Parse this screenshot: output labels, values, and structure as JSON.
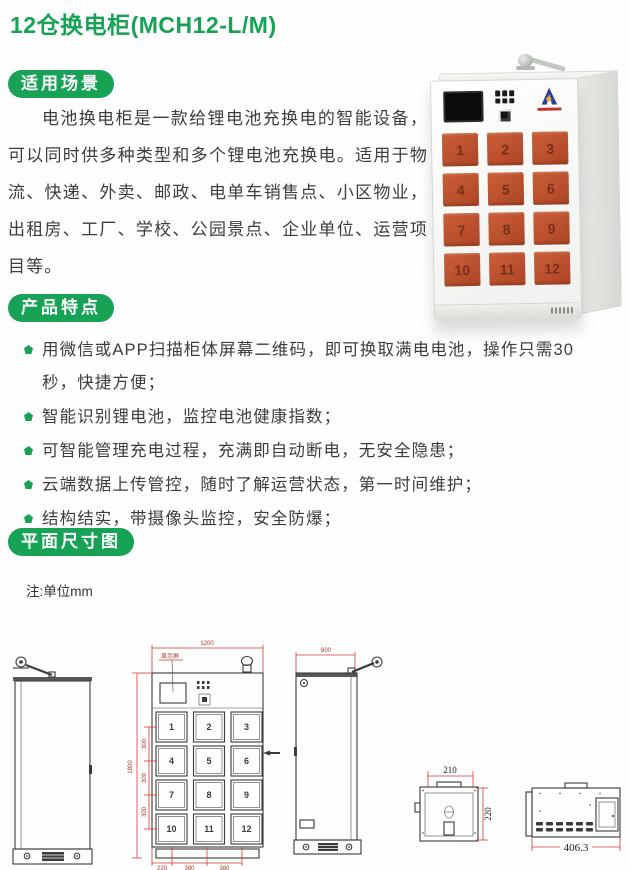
{
  "title": "12仓换电柜(MCH12-L/M)",
  "colors": {
    "accent_green": "#17a256",
    "door_orange": "#bf4e2e",
    "dimension_red": "#d93a2e",
    "logo_blue": "#2b3f9d"
  },
  "usage": {
    "badge": "适用场景",
    "paragraph": "电池换电柜是一款给锂电池充换电的智能设备，可以同时供多种类型和多个锂电池充换电。适用于物流、快递、外卖、邮政、电单车销售点、小区物业，出租房、工厂、学校、公园景点、企业单位、运营项目等。"
  },
  "features": {
    "badge": "产品特点",
    "items": [
      "用微信或APP扫描柜体屏幕二维码，即可换取满电电池，操作只需30秒，快捷方便；",
      "智能识别锂电池，监控电池健康指数；",
      "可智能管理充电过程，充满即自动断电，无安全隐患；",
      "云端数据上传管控，随时了解运营状态，第一时间维护；",
      "结构结实，带摄像头监控，安全防爆；"
    ]
  },
  "dims_section": {
    "badge": "平面尺寸图",
    "note": "注:单位mm"
  },
  "cabinet": {
    "doors": [
      "1",
      "2",
      "3",
      "4",
      "5",
      "6",
      "7",
      "8",
      "9",
      "10",
      "11",
      "12"
    ]
  },
  "drawing": {
    "front": {
      "width_label": "1200",
      "height_label": "1800",
      "segment_labels": [
        "300",
        "300",
        "300"
      ],
      "bottom_labels": [
        "220",
        "380",
        "380"
      ],
      "screen_label": "显示屏",
      "doors": [
        "1",
        "2",
        "3",
        "4",
        "5",
        "6",
        "7",
        "8",
        "9",
        "10",
        "11",
        "12"
      ]
    },
    "side": {
      "width_label": "600"
    },
    "slot_top": {
      "width_label": "210",
      "depth_label": "220"
    },
    "slot_side": {
      "length_label": "406.3"
    }
  }
}
